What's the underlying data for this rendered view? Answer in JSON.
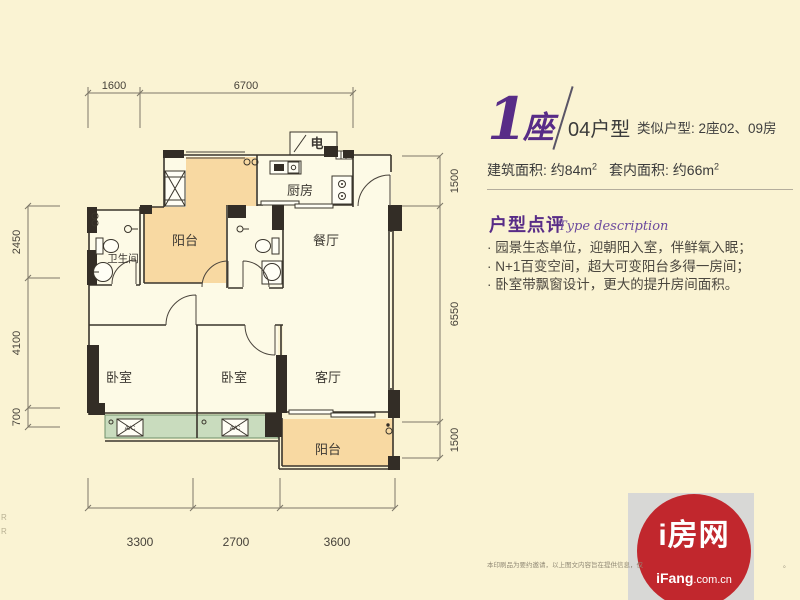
{
  "colors": {
    "bg": "#FAF3D3",
    "accent_purple": "#582C87",
    "logo_red": "#C1272D",
    "balcony_fill": "#F8D9A2",
    "bay_window_fill": "#C9DCBE",
    "wall": "#332D26"
  },
  "header": {
    "building_number": "1",
    "building_word": "座",
    "unit_code": "04户型",
    "similar": "类似户型: 2座02、09房",
    "area_built": "建筑面积: 约84m",
    "area_built_sup": "2",
    "area_inner": "套内面积: 约66m",
    "area_inner_sup": "2"
  },
  "review": {
    "title": "户型点评",
    "subtitle": "Type description",
    "bullets": [
      "· 园景生态单位，迎朝阳入室，伴鲜氧入眠；",
      "· N+1百变空间，超大可变阳台多得一房间；",
      "· 卧室带飘窗设计，更大的提升房间面积。"
    ]
  },
  "floorplan": {
    "rooms": {
      "balcony_top": "阳台",
      "kitchen": "厨房",
      "dining": "餐厅",
      "bathroom": "卫生间",
      "bedroom1": "卧室",
      "bedroom2": "卧室",
      "living": "客厅",
      "balcony_bottom": "阳台",
      "electric": "电",
      "ac1": "A/C",
      "ac2": "A/C"
    },
    "dims": {
      "top": [
        "1600",
        "6700"
      ],
      "left": [
        "2450",
        "4100",
        "700"
      ],
      "right": [
        "1500",
        "6550",
        "1500"
      ],
      "bottom": [
        "3300",
        "2700",
        "3600"
      ]
    }
  },
  "logo": {
    "name": "i房网",
    "site_bold": "iFang",
    "site_rest": ".com.cn"
  },
  "footer": {
    "disclaimer": "本印刷品为要约邀请，以上图文内容旨在提供信息，仅",
    "disclaimer_tail": "。",
    "edge_artifact": "R\nR"
  }
}
